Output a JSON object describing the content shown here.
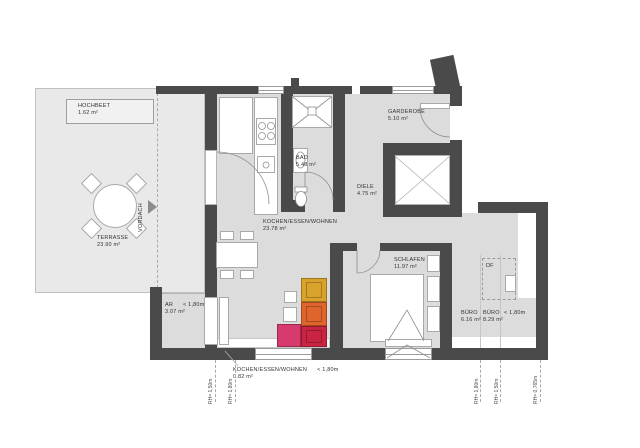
{
  "rooms": {
    "hochbeet": {
      "name": "HOCHBEET",
      "area": "1.62 m²"
    },
    "terrasse": {
      "name": "TERRASSE",
      "area": "23.90 m²"
    },
    "kochen_essen_wohnen": {
      "name": "KOCHEN/ESSEN/WOHNEN",
      "area": "23.78 m²"
    },
    "bad": {
      "name": "BAD",
      "area": "5.48 m²"
    },
    "garderobe": {
      "name": "GARDEROBE",
      "area": "5.10 m²"
    },
    "diele": {
      "name": "DIELE",
      "area": "4.75 m²"
    },
    "schlafen": {
      "name": "SCHLAFEN",
      "area": "11.97 m²"
    },
    "buero_1": {
      "name": "BÜRO",
      "area": "6.16 m²"
    },
    "buero_2": {
      "name": "BÜRO",
      "area": "8.29 m²"
    },
    "ar": {
      "name": "AR",
      "height_note": "< 1,80m",
      "area": "3.07 m²"
    },
    "kochen_essen_wohnen_low": {
      "name": "KOCHEN/ESSEN/WOHNEN",
      "height_note": "< 1,80m",
      "area": "0.82 m²"
    }
  },
  "labels": {
    "vordach": "VORDACH",
    "df": "DF",
    "buero_height_note": "< 1,80m"
  },
  "height_marks": {
    "left": [
      "RH= 1,50m",
      "RH= 1,80m"
    ],
    "right": [
      "RH= 1,80m",
      "RH= 1,50m",
      "RH= 0,765m"
    ]
  },
  "colors": {
    "wall": "#4a4a4a",
    "floor": "#dcdcdc",
    "terrace": "#e9e9e9",
    "sofa_yellow": "#d9a32b",
    "sofa_orange": "#df652c",
    "sofa_red": "#c92442",
    "sofa_pink": "#d63a6e"
  }
}
